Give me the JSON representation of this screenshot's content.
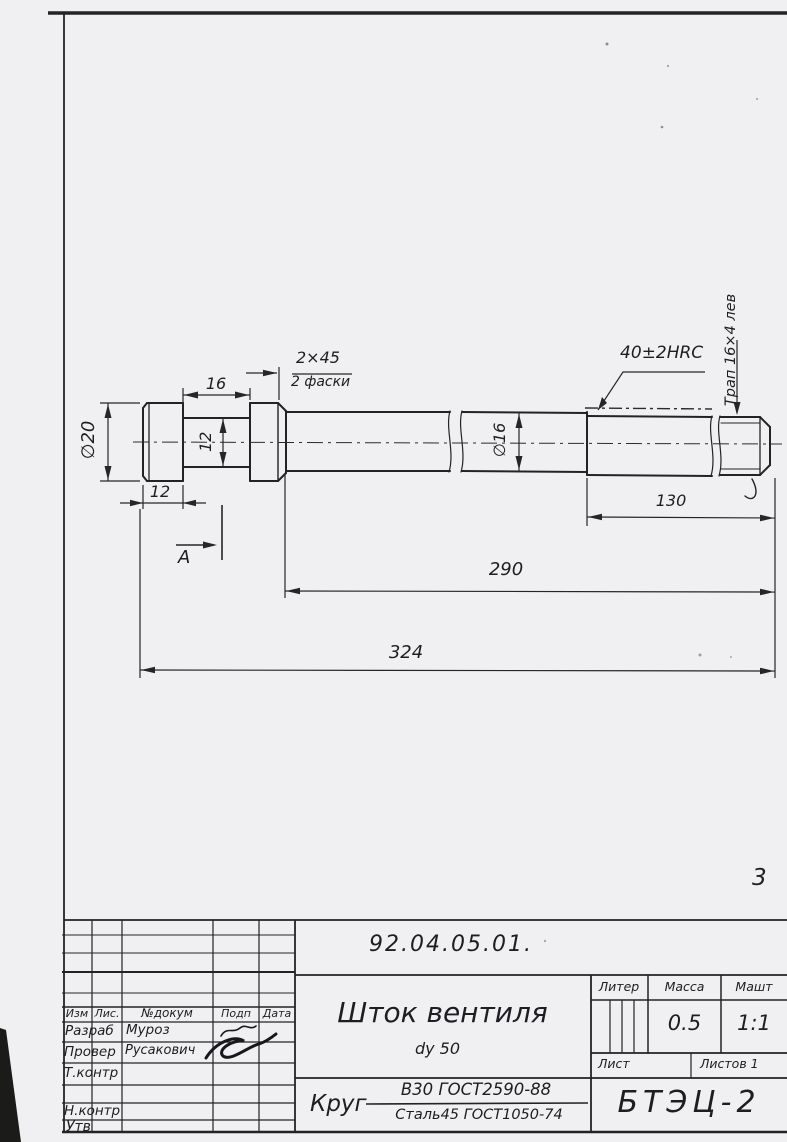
{
  "drawing_labels": {
    "dia20": "∅20",
    "len16": "16",
    "chamfer": "2×45",
    "chamfer_note": "2 фаски",
    "dia12": "12",
    "head_len": "12",
    "view": "А",
    "dia16": "∅16",
    "hardness": "40±2HRC",
    "thread": "Трап 16×4 лев",
    "len130": "130",
    "len290": "290",
    "len324": "324",
    "page_note": "3"
  },
  "title_block": {
    "designation": "92.04.05.01.",
    "part_title": "Шток вентиля",
    "part_subtitle": "dу 50",
    "material": {
      "prefix": "Круг",
      "numerator": "В30 ГОСТ2590-88",
      "denominator": "Сталь45 ГОСТ1050-74"
    },
    "org": "БТЭЦ-2",
    "header": {
      "izm": "Изм",
      "list": "Лис.",
      "doc": "№докум",
      "sign": "Подп",
      "date": "Дата"
    },
    "roles": {
      "developed": "Разраб",
      "checked": "Провер",
      "tcontrol": "Т.контр",
      "ncontrol": "Н.контр",
      "approved": "Утв"
    },
    "names": {
      "developed": "Муроз",
      "checked": "Русакович"
    },
    "liter_label": "Литер",
    "mass_label": "Масса",
    "scale_label": "Машт",
    "mass_value": "0.5",
    "scale_value": "1:1",
    "sheet_label": "Лист",
    "sheets_label": "Листов 1"
  }
}
